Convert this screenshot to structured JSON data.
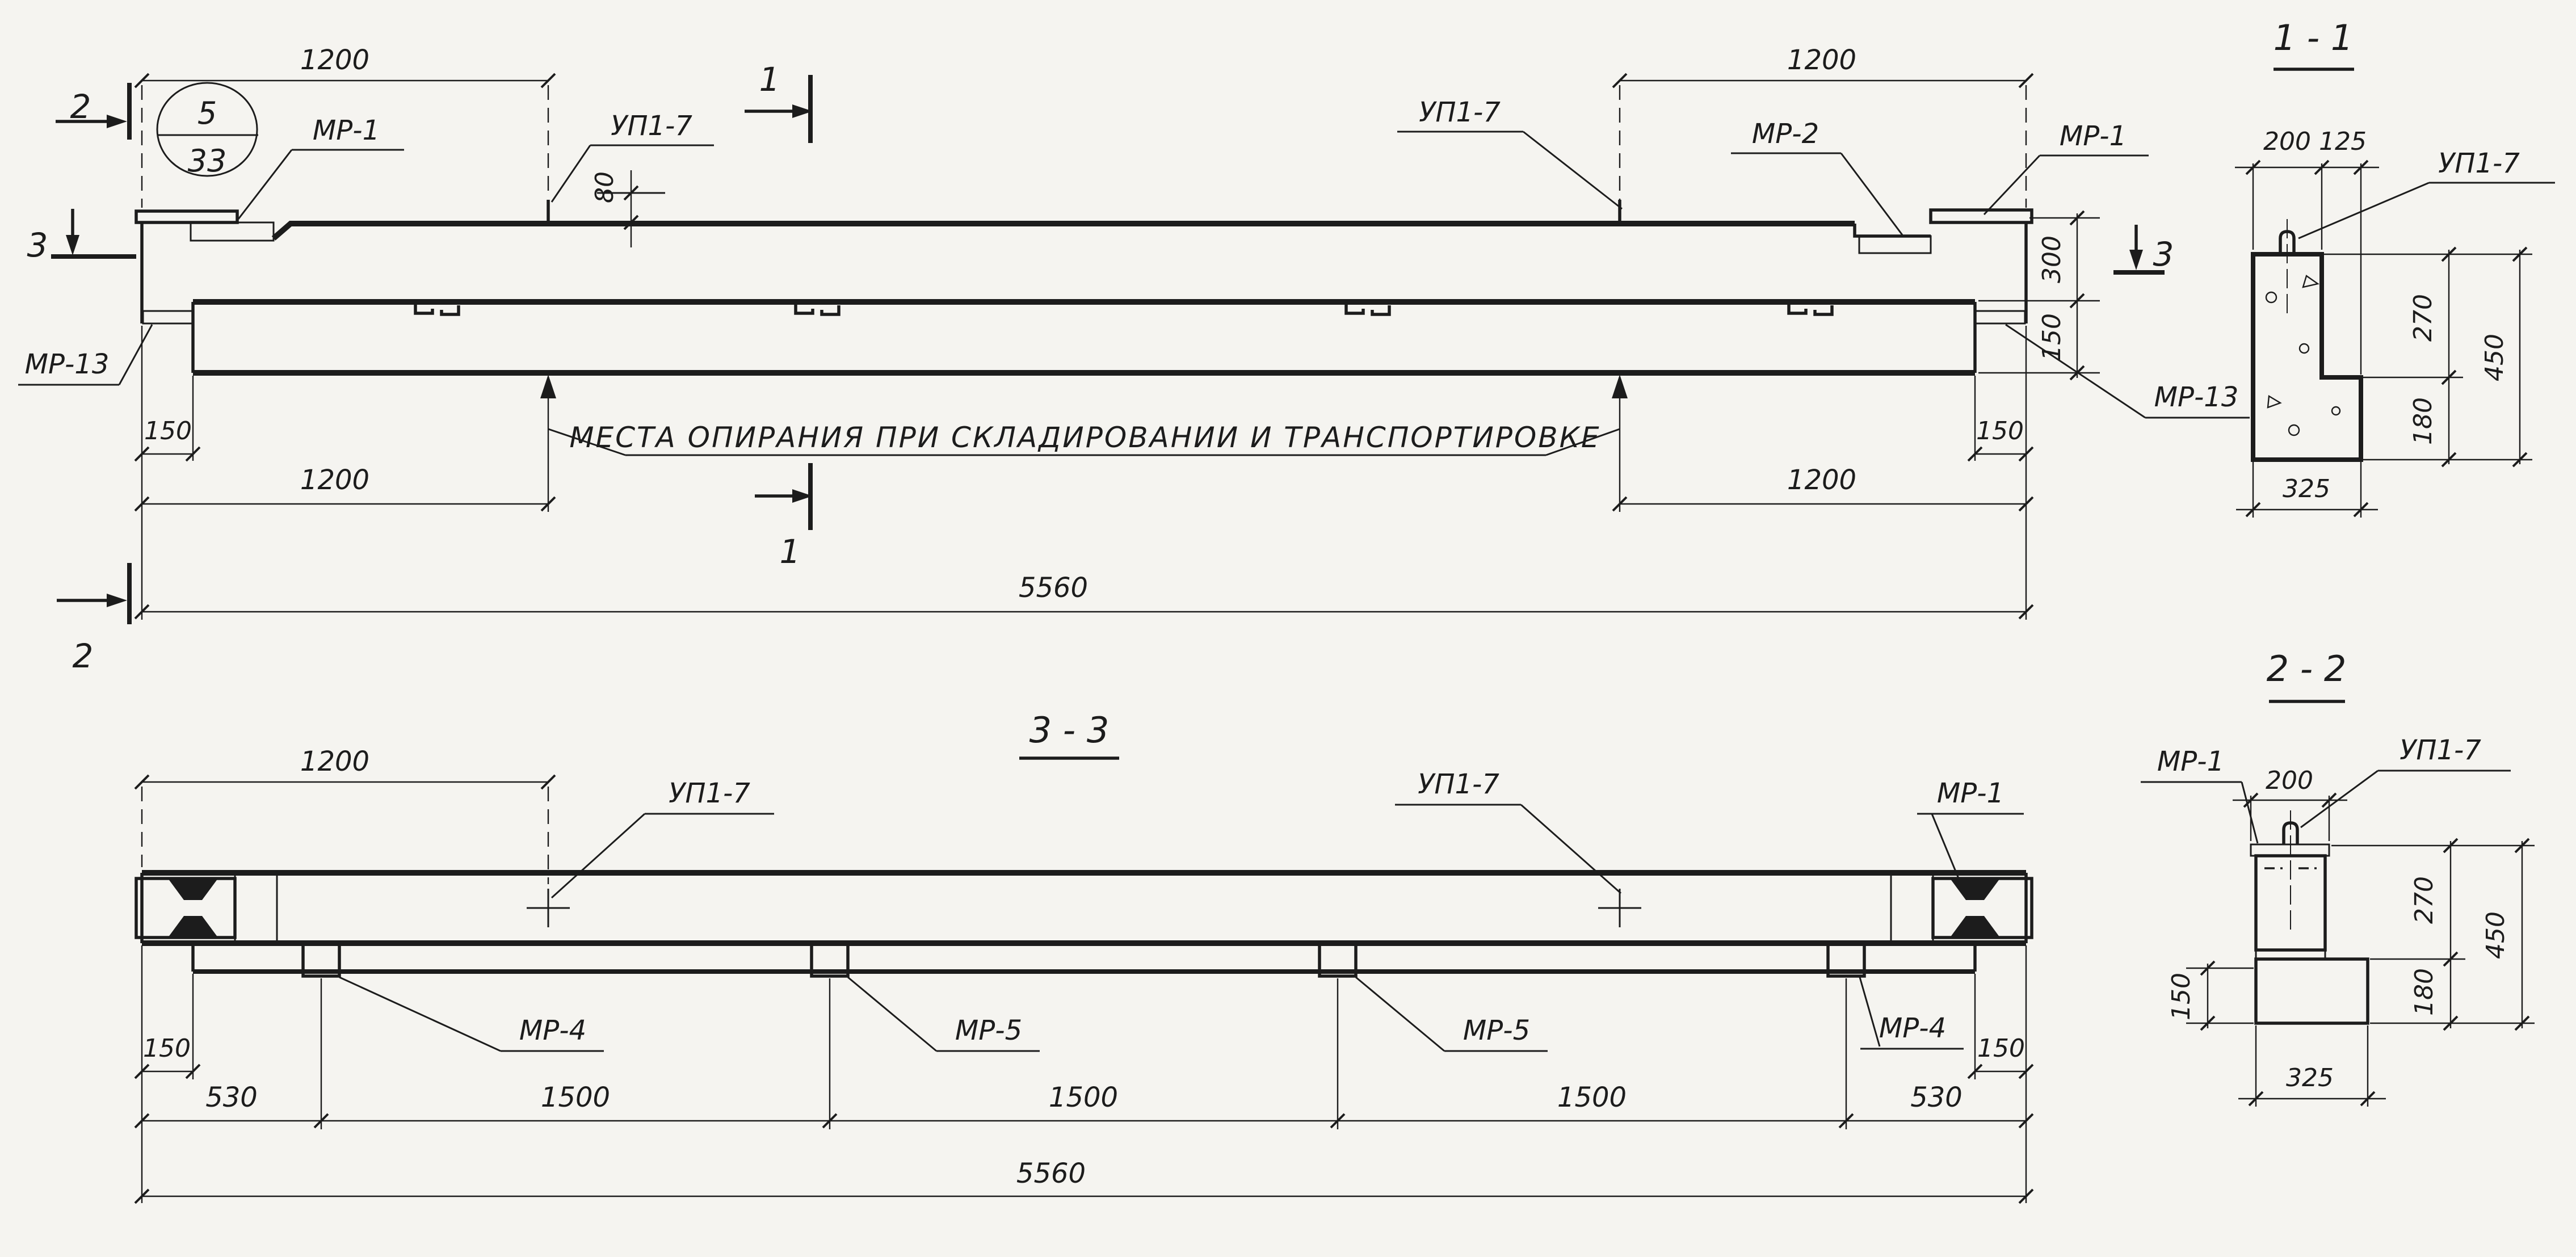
{
  "sheet": {
    "paper": "#f5f4f0",
    "ink": "#1c1c1c"
  },
  "elevation": {
    "circle": {
      "top": "5",
      "bottom": "33"
    },
    "marks": {
      "m1": "1",
      "m2": "2",
      "m3": "3"
    },
    "labels": {
      "mr1_left": "МР-1",
      "up17_left": "УП1-7",
      "up17_right": "УП1-7",
      "mr2": "МР-2",
      "mr1_right": "МР-1",
      "mr13_left": "МР-13",
      "mr13_right": "МР-13"
    },
    "dims": {
      "span_top_left": "1200",
      "span_top_right": "1200",
      "loop_height": "80",
      "rib_height": "300",
      "slab_height": "150",
      "end_left": "150",
      "end_right": "150",
      "span_bottom_left": "1200",
      "span_bottom_right": "1200",
      "total": "5560"
    },
    "note": "МЕСТА ОПИРАНИЯ ПРИ СКЛАДИРОВАНИИ И ТРАНСПОРТИРОВКЕ"
  },
  "section_1_1": {
    "title": "1 - 1",
    "label_up17": "УП1-7",
    "dims": {
      "rib_width": "200",
      "ledge_width": "125",
      "upper": "270",
      "lower": "180",
      "total": "450",
      "width": "325"
    }
  },
  "plan_3_3": {
    "title": "3 - 3",
    "labels": {
      "up17_left": "УП1-7",
      "up17_right": "УП1-7",
      "mr1": "МР-1",
      "mr4_left": "МР-4",
      "mr5_left": "МР-5",
      "mr5_right": "МР-5",
      "mr4_right": "МР-4"
    },
    "dims": {
      "span_left": "1200",
      "end_left": "150",
      "end_right": "150",
      "edge_left": "530",
      "mid1": "1500",
      "mid2": "1500",
      "mid3": "1500",
      "edge_right": "530",
      "total": "5560"
    }
  },
  "section_2_2": {
    "title": "2 - 2",
    "labels": {
      "mr1": "МР-1",
      "up17": "УП1-7"
    },
    "dims": {
      "rib_width": "200",
      "slab": "150",
      "upper": "270",
      "lower": "180",
      "total": "450",
      "width": "325"
    }
  }
}
